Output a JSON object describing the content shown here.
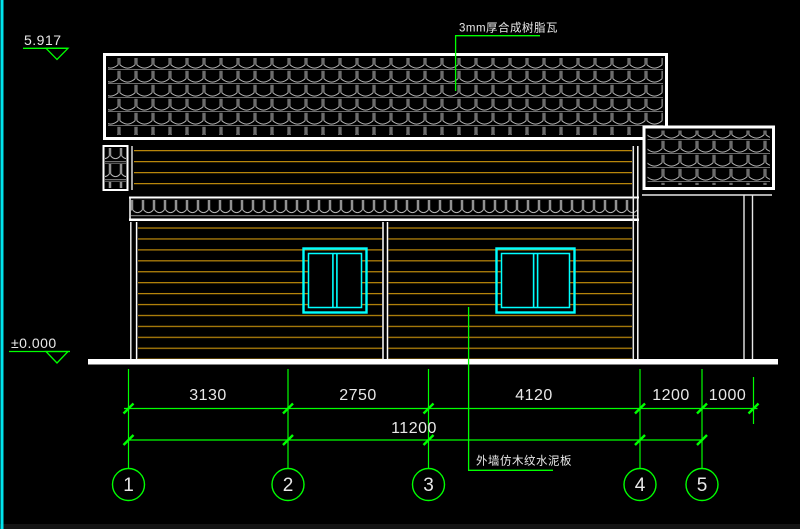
{
  "annotations": {
    "roof_material_note": "3mm厚合成树脂瓦",
    "wall_material_note": "外墙仿木纹水泥板"
  },
  "elevation_markers": {
    "roof_level": "5.917",
    "ground_level": "±0.000"
  },
  "dimensions": {
    "segments": [
      "3130",
      "2750",
      "4120",
      "1200",
      "1000"
    ],
    "overall": "11200"
  },
  "grid_axes": [
    "1",
    "2",
    "3",
    "4",
    "5"
  ],
  "colors": {
    "background": "#000000",
    "dimension_green": "#00ff00",
    "window_cyan": "#00ffff",
    "siding_orange": "#b8860b",
    "linework_white": "#ffffff",
    "tile_gray": "#b5b5b5"
  }
}
